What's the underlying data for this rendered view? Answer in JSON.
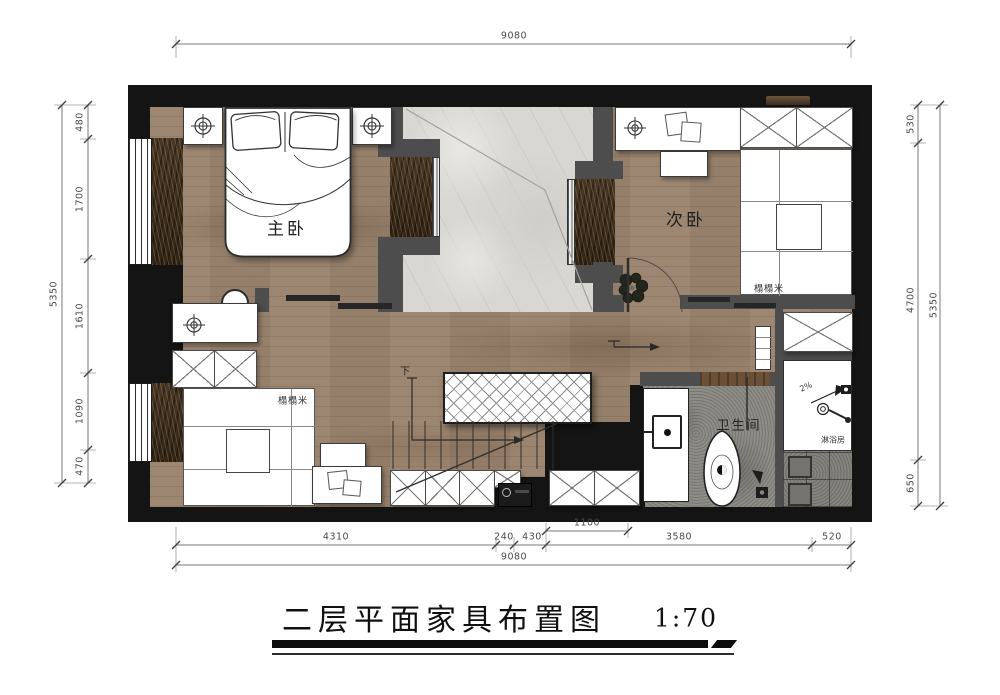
{
  "title_block": {
    "title": "二层平面家具布置图",
    "scale": "1:70"
  },
  "room_labels": {
    "master_bedroom": "主卧",
    "second_bedroom": "次卧",
    "bathroom": "卫生间",
    "shower_room": "淋浴房",
    "tatami_second_bedroom": "榻榻米",
    "tatami_study": "榻榻米",
    "stairs_down": "下",
    "shower_slope": "2%"
  },
  "dimensions": {
    "top": {
      "total": "9080"
    },
    "bottom": {
      "segments": [
        "4310",
        "240",
        "430",
        "3580",
        "520"
      ],
      "inner": "1100",
      "total": "9080"
    },
    "left": {
      "segments": [
        "480",
        "1700",
        "1610",
        "1090",
        "470"
      ],
      "total": "5350"
    },
    "right": {
      "segments": [
        "530",
        "4700",
        "650"
      ],
      "total": "5350"
    }
  },
  "colors": {
    "outer_wall": "#141414",
    "partition_wall": "#4d4d4d",
    "wood_floor": "#a28c77",
    "dark_wood": "#3f2f1e",
    "marble": "#d8d7d4",
    "stone": "#8e8c86"
  }
}
